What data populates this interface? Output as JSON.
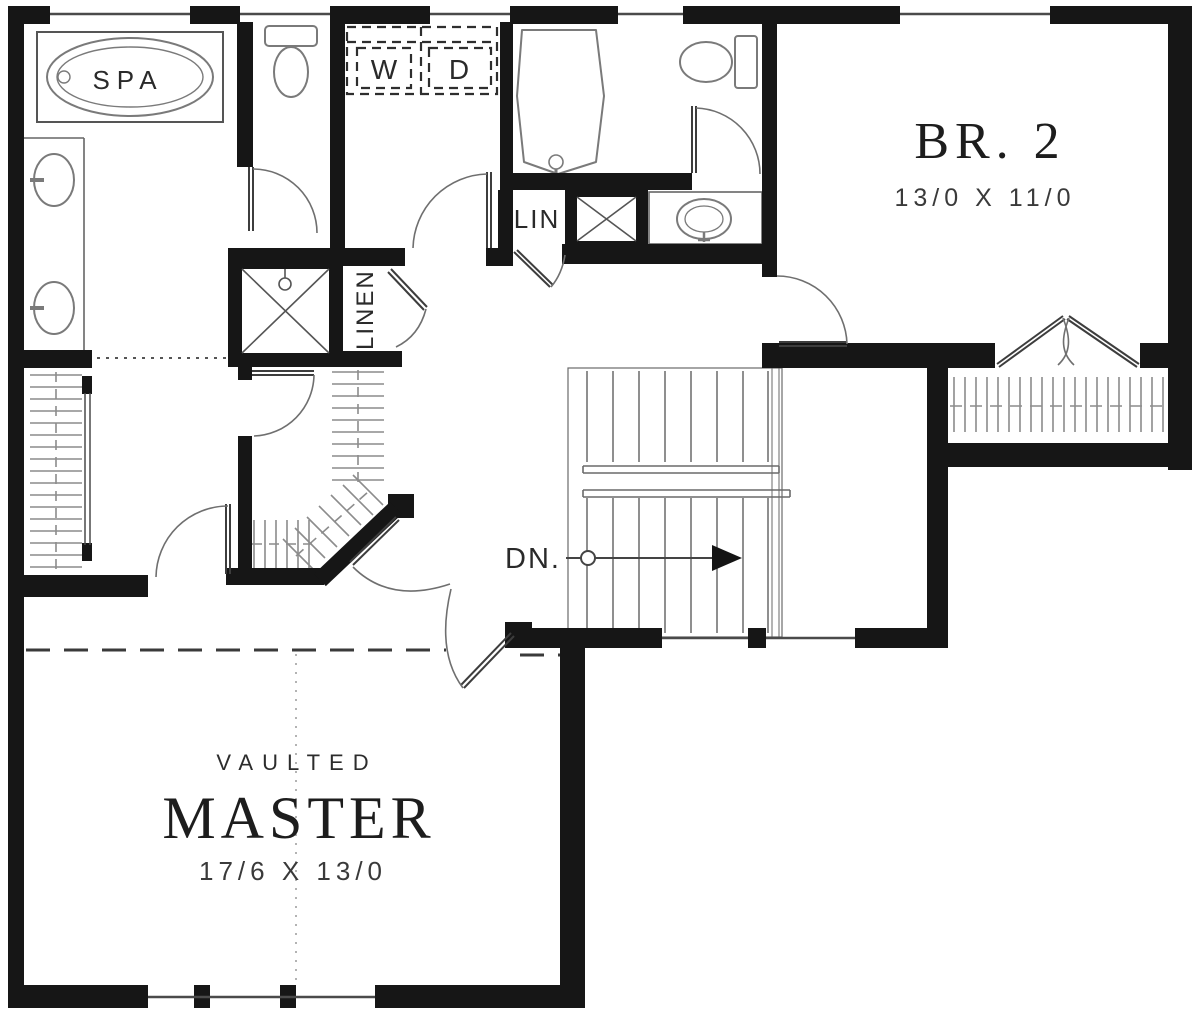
{
  "plan": {
    "rooms": [
      {
        "id": "master-bedroom",
        "qualifier": "VAULTED",
        "name": "MASTER",
        "dimensions": "17/6 X 13/0"
      },
      {
        "id": "bedroom-2",
        "name": "BR. 2",
        "dimensions": "13/0 X 11/0"
      }
    ],
    "fixtures": {
      "spa_tub": "SPA",
      "washer": "W",
      "dryer": "D",
      "linen_closet": "LIN",
      "linen_closet_tall": "LINEN"
    },
    "stairs": {
      "direction_label": "DN."
    },
    "colors": {
      "background": "#ffffff",
      "walls": "#161616",
      "window_lines": "#4a4a4a",
      "fixture_lines": "#7a7a7a",
      "door_lines": "#3d3d3d",
      "swing_arcs": "#6f6f6f",
      "hatch_lines": "#8c8c8c",
      "stair_lines": "#6a6a6a",
      "text": "#232323",
      "dimension_text": "#3a3a3a"
    }
  }
}
